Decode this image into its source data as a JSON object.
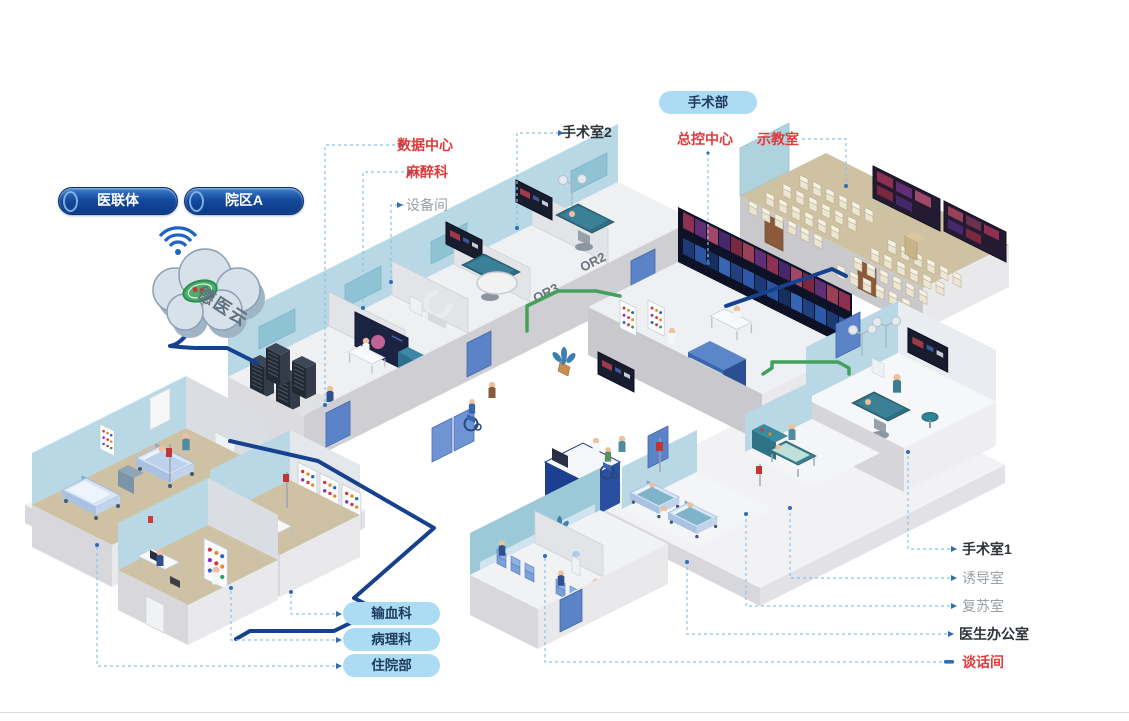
{
  "network": {
    "pills": {
      "yi_lian_ti": "医联体",
      "yuan_qu_a": "院区A"
    },
    "cloud": {
      "name": "德医云"
    }
  },
  "department_pill": "手术部",
  "labels": {
    "shu_ju_zhong_xin": "数据中心",
    "ma_zui_ke": "麻醉科",
    "she_bei_jian": "设备间",
    "shou_shu_shi_2": "手术室2",
    "zong_kong_zhong_xin": "总控中心",
    "shi_jiao_shi": "示教室",
    "shou_shu_shi_1": "手术室1",
    "you_dao_shi": "诱导室",
    "fu_su_shi": "复苏室",
    "yi_sheng_ban_gong_shi": "医生办公室",
    "tan_hua_jian": "谈话间"
  },
  "bottom_pills": {
    "shu_xue_ke": "输血科",
    "bing_li_ke": "病理科",
    "zhu_yuan_bu": "住院部"
  },
  "wall_labels": {
    "or2": "OR2",
    "or3": "OR3"
  },
  "colors": {
    "red_label": "#e03a3a",
    "gray_label": "#9aa0a6",
    "dark_label": "#2f343b",
    "navy_pill": "#11459a",
    "light_pill": "#abdcf4",
    "pill_text": "#1d3a5f",
    "cable_navy": "#16418f",
    "cable_green": "#44a05c",
    "leader_line": "#8ec0ea",
    "wifi": "#1f63c6",
    "floor_tan": "#cfc2a4",
    "wall_blue": "#b7d8e4"
  }
}
